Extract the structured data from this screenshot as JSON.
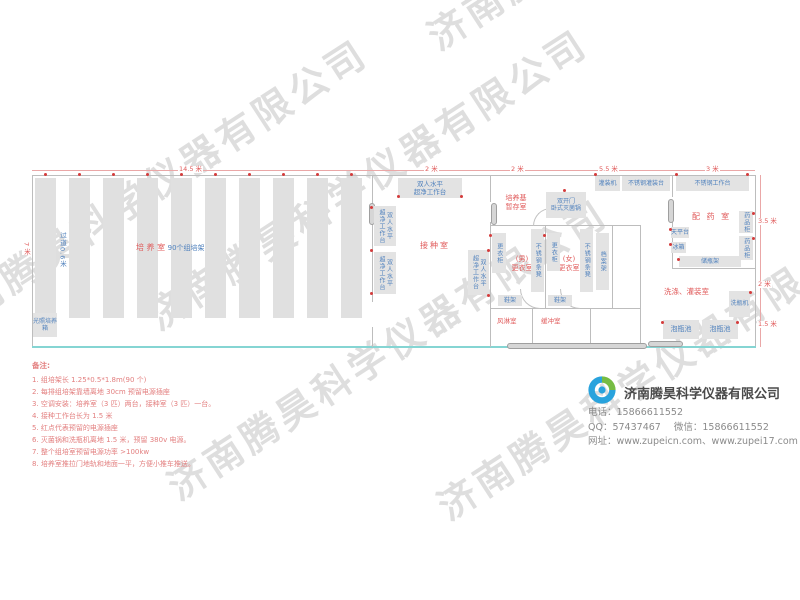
{
  "watermark": {
    "text": "济南腾昊科学仪器有限公司"
  },
  "colors": {
    "accent_red": "#e05a5a",
    "equipment_blue": "#4f81bd",
    "equipment_fill": "#e3e3e3",
    "wall_gray": "#bdbdbd",
    "door_track_cyan": "#85d5d3",
    "logo_blue": "#29a3dd",
    "logo_green": "#76bc43"
  },
  "plan": {
    "dims": {
      "top1": "14.5 米",
      "top2": "2 米",
      "top3": "2 米",
      "top4": "5.5 米",
      "top5": "3 米",
      "right1": "3.5 米",
      "right2": "2 米",
      "right3": "1.5 米",
      "left1": "7 米"
    },
    "rooms": {
      "culture": "培 养 室",
      "culture_sub": "90个组培架",
      "aisle": "过道0.6米",
      "inoculation": "接种室",
      "medium1": "培养基",
      "medium2": "暂存室",
      "men1": "(男)",
      "men2": "更衣室",
      "women1": "(女)",
      "women2": "更衣室",
      "air_shower": "风淋室",
      "buffer": "缓冲室",
      "pharmacy": "配 药 室",
      "washing": "洗涤、灌装室"
    },
    "equipment": {
      "incubator": "光照培养箱",
      "workbench1": "双人水平",
      "workbench2": "超净工作台",
      "sterilizer1": "双开门",
      "sterilizer2": "卧式灭菌锅",
      "filling_machine": "灌装机",
      "filling_table": "不锈钢灌装台",
      "work_table": "不锈钢工作台",
      "locker": "更衣柜",
      "stool": "不锈钢条凳",
      "shoe_rack": "鞋架",
      "file_rack": "档案架",
      "balance": "天平台",
      "fridge": "冰箱",
      "bottle_shelf": "储瓶架",
      "med_cabinet": "药品柜",
      "bottle_washer": "洗瓶机",
      "soak_pool": "泡瓶池"
    }
  },
  "notes": {
    "title": "备注:",
    "items": [
      "1. 组培架长 1.25*0.5*1.8m(90 个)",
      "2. 每排组培架靠墙离地 30cm 预留电源插座",
      "3. 空调安装：培养室（3 匹）两台，接种室（3 匹）一台。",
      "4. 接种工作台长为 1.5 米",
      "5. 红点代表预留的电源插座",
      "6. 灭菌锅和洗瓶机离地 1.5 米，预留 380v 电源。",
      "7. 整个组培室预留电源功率 >100kw",
      "8. 培养室推拉门地轨和地面一平，方便小推车推送。"
    ]
  },
  "company": {
    "name": "济南腾昊科学仪器有限公司",
    "phone_label": "电话：",
    "phone": "15866611552",
    "qq_label": "QQ：",
    "qq": "57437467",
    "wechat_label": "微信：",
    "wechat": "15866611552",
    "web_label": "网址：",
    "web": "www.zupeicn.com、www.zupei17.com"
  }
}
